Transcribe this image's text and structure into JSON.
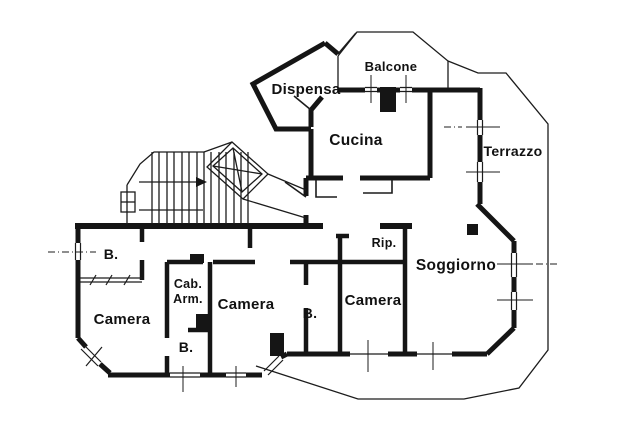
{
  "colors": {
    "ink": "#151515",
    "paper": "#ffffff"
  },
  "rooms": {
    "dispensa": "Dispensa",
    "balcone": "Balcone",
    "cucina": "Cucina",
    "terrazzo": "Terrazzo",
    "soggiorno": "Soggiorno",
    "rip": "Rip.",
    "camera_center": "Camera",
    "camera_right": "Camera",
    "camera_left": "Camera",
    "bagno_top_left": "B.",
    "bagno_center": "B.",
    "bagno_right": "B.",
    "cabina_armadio_line1": "Cab.",
    "cabina_armadio_line2": "Arm."
  }
}
